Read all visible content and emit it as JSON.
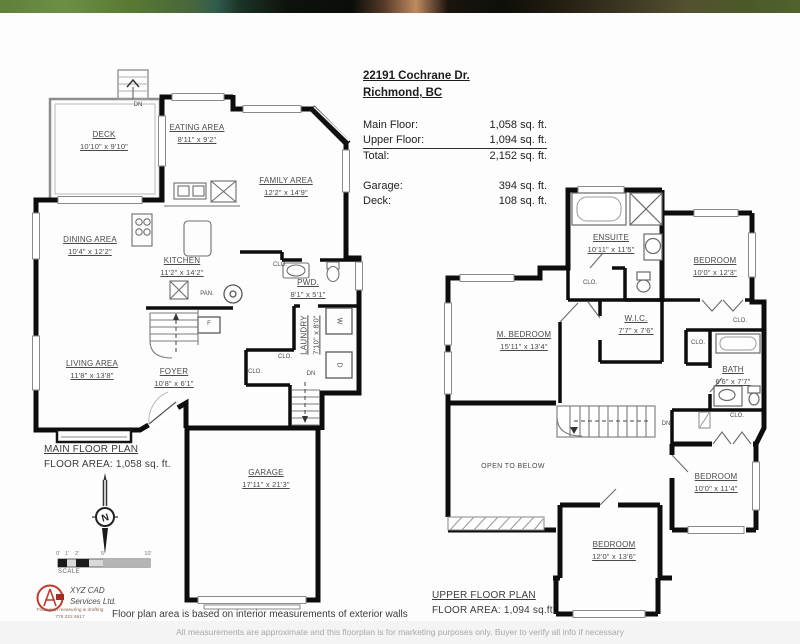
{
  "header": {
    "address_line1": "22191 Cochrane Dr.",
    "address_line2": "Richmond, BC",
    "area_rows": [
      {
        "label": "Main Floor:",
        "value": "1,058 sq. ft."
      },
      {
        "label": "Upper Floor:",
        "value": "1,094 sq. ft."
      },
      {
        "label": "Total:",
        "value": "2,152 sq. ft."
      }
    ],
    "extra_rows": [
      {
        "label": "Garage:",
        "value": "394 sq. ft."
      },
      {
        "label": "Deck:",
        "value": "108 sq. ft."
      }
    ]
  },
  "main_floor": {
    "title": "MAIN FLOOR PLAN",
    "area_text": "FLOOR AREA: 1,058 sq. ft.",
    "rooms": [
      {
        "name": "DECK",
        "dims": "10'10\" x 9'10\""
      },
      {
        "name": "EATING AREA",
        "dims": "8'11\" x 9'2\""
      },
      {
        "name": "FAMILY AREA",
        "dims": "12'2\" x 14'9\""
      },
      {
        "name": "DINING AREA",
        "dims": "10'4\" x 12'2\""
      },
      {
        "name": "KITCHEN",
        "dims": "11'2\" x 14'2\""
      },
      {
        "name": "PWD.",
        "dims": "8'1\" x 5'1\""
      },
      {
        "name": "LAUNDRY",
        "dims": "7'10\" x 8'0\""
      },
      {
        "name": "LIVING AREA",
        "dims": "11'8\" x 13'8\""
      },
      {
        "name": "FOYER",
        "dims": "10'8\" x 6'1\""
      },
      {
        "name": "GARAGE",
        "dims": "17'11\" x 21'3\""
      }
    ],
    "annotations": {
      "deck_stairs": "DN",
      "stairs_up": "UP",
      "basement_stairs": "DN",
      "pantry": "PAN.",
      "furnace": "F",
      "washer": "W",
      "dryer": "D",
      "closet1": "CLO.",
      "closet2": "CLO.",
      "closet3": "CLO."
    }
  },
  "upper_floor": {
    "title": "UPPER FLOOR PLAN",
    "area_text": "FLOOR AREA: 1,094 sq.ft.",
    "rooms": [
      {
        "name": "ENSUITE",
        "dims": "10'11\" x 11'5\""
      },
      {
        "name": "BEDROOM",
        "dims": "10'0\" x 12'3\""
      },
      {
        "name": "M. BEDROOM",
        "dims": "15'11\" x 13'4\""
      },
      {
        "name": "W.I.C.",
        "dims": "7'7\" x 7'6\""
      },
      {
        "name": "BATH",
        "dims": "6'6\" x 7'7\""
      },
      {
        "name": "BEDROOM",
        "dims": "10'0\" x 11'4\""
      },
      {
        "name": "BEDROOM",
        "dims": "12'0\" x 13'6\""
      }
    ],
    "open_to_below": "OPEN TO BELOW",
    "annotations": {
      "closet1": "CLO.",
      "closet2": "CLO.",
      "closet3": "CLO.",
      "closet4": "CLO.",
      "stairs_down": "DN"
    }
  },
  "compass": {
    "label": "N"
  },
  "scale_bar": {
    "ticks": [
      "0'",
      "1'",
      "2'",
      "5'",
      "10'"
    ],
    "caption": "SCALE"
  },
  "footer": {
    "logo_line1": "XYZ CAD",
    "logo_line2": "Services Ltd.",
    "logo_sub1": "Floor plan measuring & drafting",
    "logo_sub2": "778 322 6617",
    "note": "Floor plan area is based on interior measurements of exterior walls",
    "disclaimer": "All measurements are approximate and this floorplan is for marketing purposes only. Buyer to verify all info if necessary"
  },
  "colors": {
    "walls": "#0d0d0d",
    "label_text": "#4a4a4a",
    "logo_red": "#c03a2b"
  }
}
